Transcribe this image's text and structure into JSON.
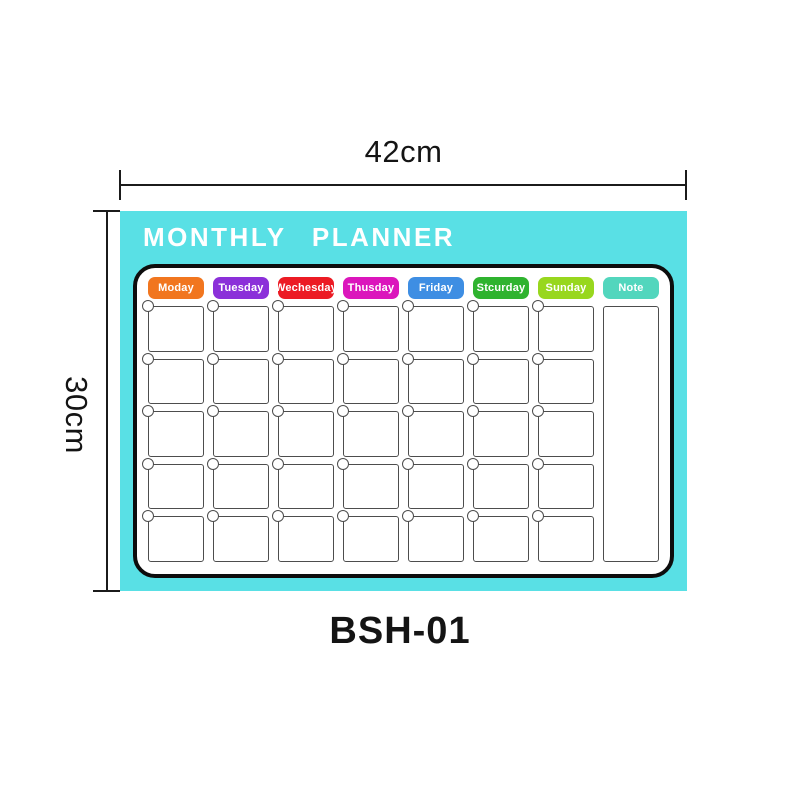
{
  "product": {
    "model": "BSH-01",
    "board_title": "MONTHLY PLANNER",
    "width_label": "42cm",
    "height_label": "30cm"
  },
  "calendar": {
    "headers": [
      {
        "label": "Moday",
        "color": "#F1761F"
      },
      {
        "label": "Tuesday",
        "color": "#8B30D9"
      },
      {
        "label": "Wechesday",
        "color": "#EC1B24"
      },
      {
        "label": "Thusday",
        "color": "#DB16BC"
      },
      {
        "label": "Friday",
        "color": "#3E8EE3"
      },
      {
        "label": "Stcurday",
        "color": "#2FB32F"
      },
      {
        "label": "Sunday",
        "color": "#98D71E"
      },
      {
        "label": "Note",
        "color": "#52D6BD"
      }
    ],
    "rows": 5,
    "day_columns": 7
  },
  "colors": {
    "board_background": "#59E0E5",
    "panel_border": "#0d0d0d",
    "cell_border": "#4d4d4d",
    "dimension_line": "#1b1b1b"
  }
}
